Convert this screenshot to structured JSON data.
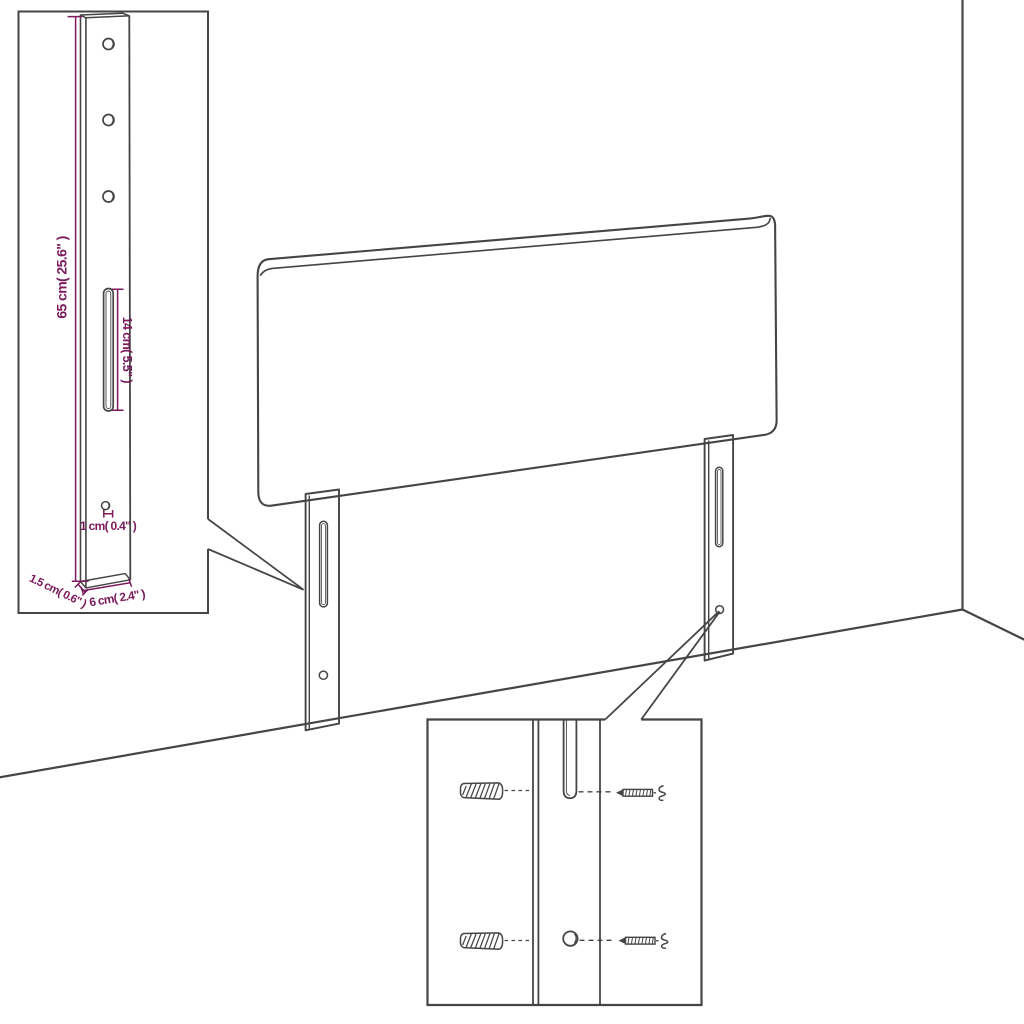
{
  "colors": {
    "background": "#ffffff",
    "line_art": "#454545",
    "dimension_annotations": "#7b1a5c"
  },
  "annotations": {
    "bracket_height_label": "65 cm( 25.6\" )",
    "slot_length_label": "14 cm( 5.5\" )",
    "hole_diameter_label": "1 cm( 0.4\" )",
    "bracket_depth_label": "1.5 cm( 0.6\" )",
    "bracket_width_label": "6 cm( 2.4\" )"
  }
}
